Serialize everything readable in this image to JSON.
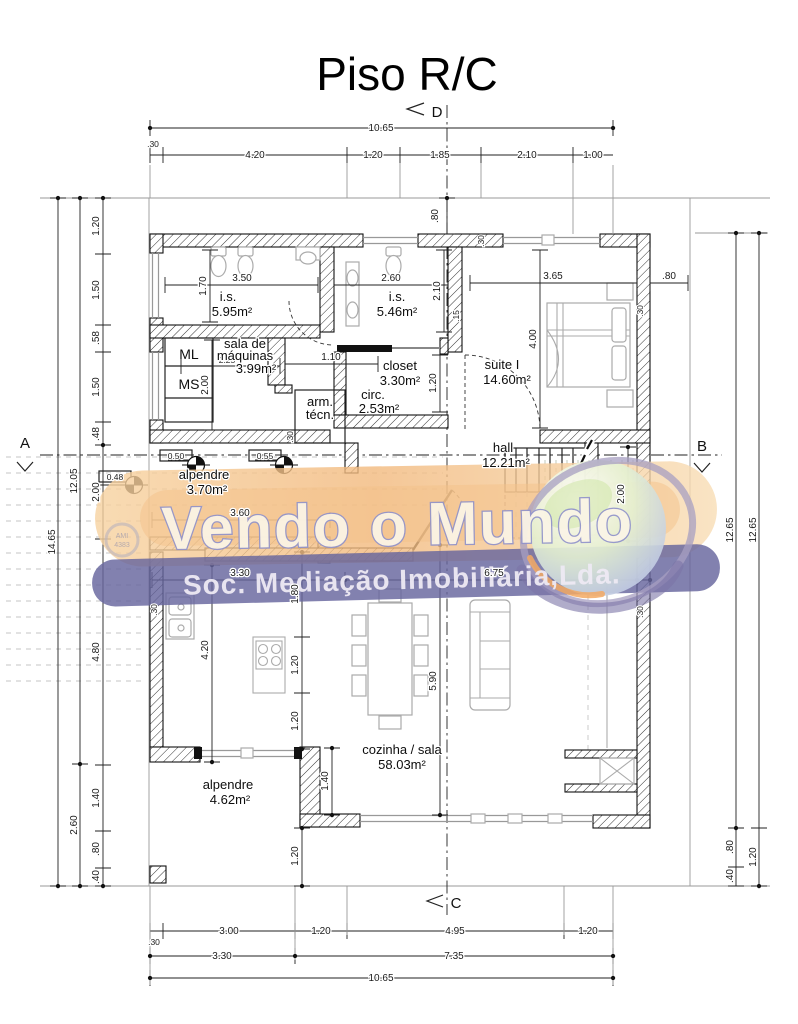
{
  "title": "Piso R/C",
  "section_markers": {
    "top": "D",
    "bottom": "C",
    "left": "A",
    "right": "B"
  },
  "watermark": {
    "brand": "Vendo o Mundo",
    "subtitle": "Soc. Mediação Imobiliária,Lda.",
    "emblem_line1": "AMI",
    "emblem_line2": "4383"
  },
  "appliances": {
    "ml": "ML",
    "ms": "MS"
  },
  "rooms": {
    "is1": {
      "name": "i.s.",
      "area": "5.95m²"
    },
    "is2": {
      "name": "i.s.",
      "area": "5.46m²"
    },
    "machines": {
      "name1": "sala de",
      "name2": "máquinas",
      "area": "3.99m²"
    },
    "closet": {
      "name": "closet",
      "area": "3.30m²"
    },
    "suite": {
      "name": "suite I",
      "area": "14.60m²"
    },
    "circ": {
      "name": "circ.",
      "area": "2.53m²"
    },
    "tech": {
      "name1": "arm.",
      "name2": "técn."
    },
    "porch_front": {
      "name": "alpendre",
      "area": "3.70m²"
    },
    "hall": {
      "name": "hall",
      "area": "12.21m²"
    },
    "kitchen_living": {
      "name": "cozinha / sala",
      "area": "58.03m²"
    },
    "porch_back": {
      "name": "alpendre",
      "area": "4.62m²"
    }
  },
  "dims": {
    "top_total": "10.65",
    "top": [
      ".30",
      "4.20",
      "1.20",
      "1.85",
      "2.10",
      "1.00"
    ],
    "bottom": [
      ".30",
      "3.00",
      "1.20",
      "4.95",
      "1.20"
    ],
    "bottom_mid": [
      "3.30",
      "7.35"
    ],
    "bottom_total": "10.65",
    "left_outer": "14.65",
    "left_mid": [
      "12.05",
      "2.60"
    ],
    "left_inner": [
      "1.20",
      "1.50",
      ".58",
      "1.50",
      ".48",
      "2.00",
      "4.80",
      "1.40",
      ".80",
      ".40"
    ],
    "right_chain_a": [
      "12.65",
      ".80",
      ".40"
    ],
    "right_chain_b": [
      "12.65",
      "1.20"
    ],
    "interior": {
      "top_off": ".80",
      "is1_w": "3.50",
      "is1_h": "1.70",
      "is2_w": "2.60",
      "is2_h": "2.10",
      "suite_w": "3.65",
      "suite_off": ".80",
      "suite_h": "4.00",
      "closet_h": "1.20",
      "maq_w": "2.25",
      "maq_h": "2.00",
      "corr_w": "1.10",
      "wall15": ".15",
      "wall30_top": ".30",
      "wall30_right": ".30",
      "wall30_hall": ".30",
      "wall30_kitchen": ".30",
      "wall30_living": ".30",
      "bench1": "0.50",
      "bench2": "0.55",
      "bench3": "0.48",
      "entry_w": "3.60",
      "hall_d": "2.00",
      "kitchen_w": "3.30",
      "living_w": "6.75",
      "island_off": "1.80",
      "island_h1": "1.20",
      "island_h2": "1.20",
      "kitchen_d": "4.20",
      "living_d": "5.90",
      "porch2_d": "1.40",
      "porch2_b": "1.20"
    }
  }
}
